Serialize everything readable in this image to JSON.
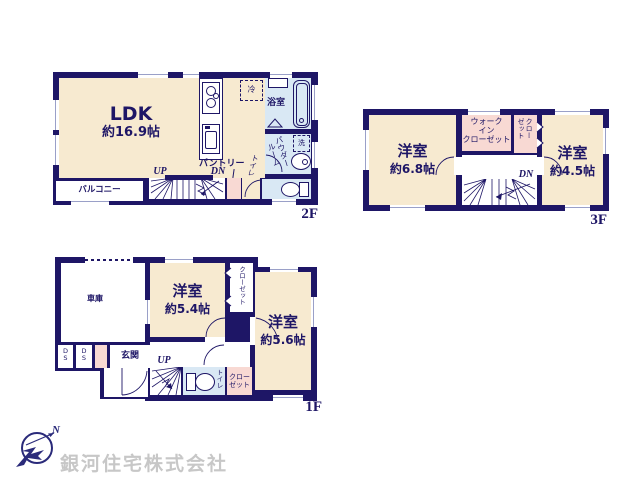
{
  "colors": {
    "wall": "#1e1666",
    "room_cream": "#f7ead0",
    "wet_blue": "#d9e8f4",
    "closet_pink": "#f8d9d3",
    "window_line": "#9aa0c8",
    "company_gray": "#c7c7c7"
  },
  "floor2": {
    "tag": "2F",
    "ldk": {
      "name": "LDK",
      "size": "約16.9帖"
    },
    "balcony": "バルコニー",
    "bath": "浴室",
    "powder": [
      "パウダー",
      "ルーム"
    ],
    "wash": "洗",
    "fridge": "冷",
    "pantry": "パントリー",
    "toilet": "トイレ",
    "up": "UP",
    "dn": "DN"
  },
  "floor3": {
    "tag": "3F",
    "room_a": {
      "name": "洋室",
      "size": "約6.8帖"
    },
    "wic": [
      "ウォーク",
      "イン",
      "クローゼット"
    ],
    "closet": [
      "クロー",
      "ゼット"
    ],
    "room_b": {
      "name": "洋室",
      "size": "約4.5帖"
    },
    "dn": "DN"
  },
  "floor1": {
    "tag": "1F",
    "garage": "車庫",
    "room_a": {
      "name": "洋室",
      "size": "約5.4帖"
    },
    "closet_tall": "クローゼット",
    "room_b": {
      "name": "洋室",
      "size": "約5.6帖"
    },
    "entrance": "玄関",
    "ds": [
      "D",
      "S"
    ],
    "up": "UP",
    "toilet": "トイレ",
    "closet_low": [
      "クロー",
      "ゼット"
    ]
  },
  "footer": {
    "company": "銀河住宅株式会社",
    "north": "N"
  }
}
